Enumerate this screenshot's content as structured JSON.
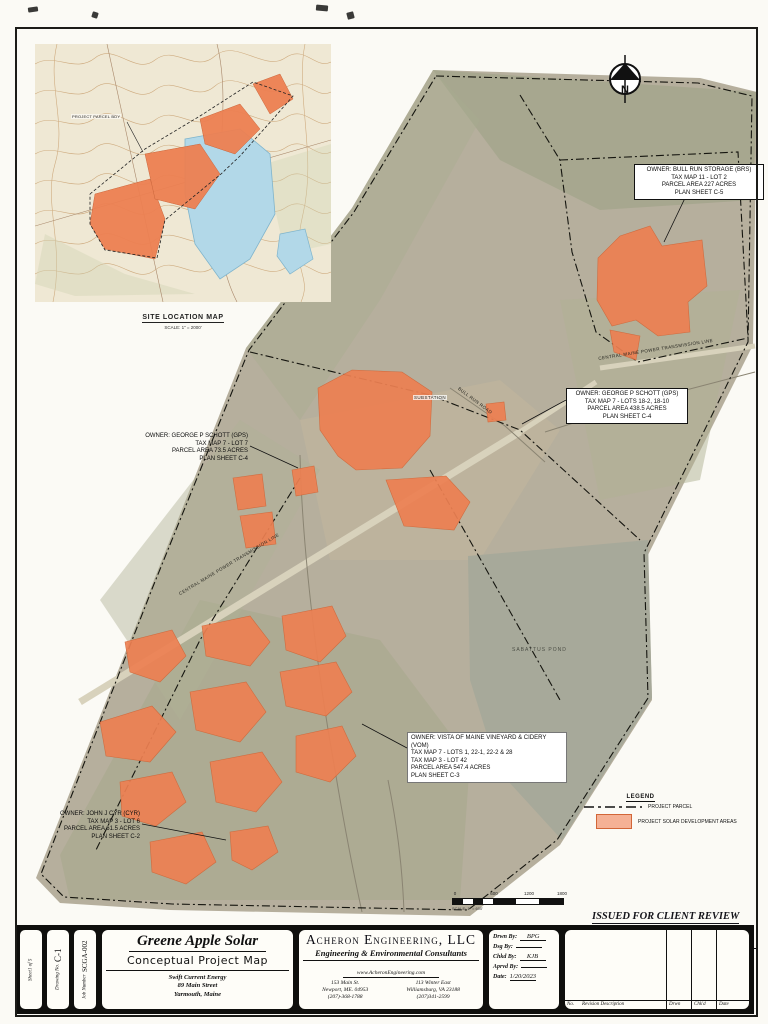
{
  "inset": {
    "title": "SITE LOCATION MAP",
    "scale": "SCALE: 1\" = 2000'",
    "parcel_label": "PROJECT PARCEL BDY"
  },
  "north_label": "N",
  "map_labels": {
    "substation": "SUBSTATION",
    "bull_run_road": "BULL RUN ROAD",
    "cmp_line": "CENTRAL MAINE POWER TRANSMISSION LINE",
    "sabattus_pond": "SABATTUS POND"
  },
  "annotations": {
    "brs": {
      "lines": [
        "OWNER: BULL RUN STORAGE (BRS)",
        "TAX MAP 11 - LOT 2",
        "PARCEL AREA 227 ACRES",
        "PLAN SHEET C-5"
      ]
    },
    "gps_east": {
      "lines": [
        "OWNER: GEORGE P SCHOTT (GPS)",
        "TAX MAP 7 - LOTS 18-2, 18-10",
        "PARCEL AREA 438.5 ACRES",
        "PLAN SHEET C-4"
      ]
    },
    "gps_west": {
      "lines": [
        "OWNER: GEORGE P SCHOTT (GPS)",
        "TAX MAP 7 - LOT 7",
        "PARCEL AREA 73.5 ACRES",
        "PLAN SHEET C-4"
      ]
    },
    "vom": {
      "lines": [
        "OWNER: VISTA OF MAINE VINEYARD & CIDERY (VOM)",
        "TAX MAP 7 - LOTS 1, 22-1, 22-2 & 28",
        "TAX MAP 3 - LOT 42",
        "PARCEL AREA 547.4 ACRES",
        "PLAN SHEET C-3"
      ]
    },
    "cyr": {
      "lines": [
        "OWNER: JOHN J CYR (CYR)",
        "TAX MAP 3 - LOT 6",
        "PARCEL AREA 61.5 ACRES",
        "PLAN SHEET C-2"
      ]
    }
  },
  "legend": {
    "title": "LEGEND",
    "parcel_label": "PROJECT PARCEL",
    "solar_label": "PROJECT SOLAR DEVELOPMENT AREAS"
  },
  "scalebar": {
    "ticks": [
      "0",
      "600",
      "1200",
      "1800"
    ],
    "caption": "SCALE: 1\" = 600'"
  },
  "stamp": {
    "line1": "ISSUED FOR CLIENT REVIEW",
    "line2": "DO NOT USE FOR CONSTRUCTION"
  },
  "titleblock": {
    "project": {
      "title": "Greene Apple Solar",
      "subtitle": "Conceptual Project Map",
      "client": [
        "Swift Current Energy",
        "89 Main Street",
        "Yarmouth, Maine"
      ]
    },
    "firm": {
      "name": "Acheron Engineering, LLC",
      "tagline": "Engineering & Environmental Consultants",
      "website": "www.AcheronEngineering.com",
      "office1": [
        "153 Main St.",
        "Newport, ME. 04953",
        "(207)-368-1788"
      ],
      "office2": [
        "113 Winter East",
        "Williamsburg, VA 23188",
        "(207)341-2599"
      ]
    },
    "fields": [
      {
        "label": "Drwn By:",
        "value": "BPG"
      },
      {
        "label": "Dsg By:",
        "value": ""
      },
      {
        "label": "Chkd By:",
        "value": "KJB"
      },
      {
        "label": "Aprvd By:",
        "value": ""
      },
      {
        "label": "Date:",
        "value": "1/20/2023"
      }
    ],
    "revision": {
      "no": "No.",
      "description": "Revision Description",
      "drwn": "Drwn",
      "chkd": "Chk'd",
      "date": "Date"
    }
  },
  "sheet_meta": {
    "sheet": {
      "label": "Sheet",
      "value": "1 of 5"
    },
    "drawing": {
      "label": "Drawing No.",
      "value": "C-1"
    },
    "job": {
      "label": "Job Number",
      "value": "SCGA-002"
    }
  },
  "colors": {
    "solar_fill": "#ED8052",
    "solar_stroke": "#D26638",
    "photo_base": "#B6AF9D",
    "pond": "#A7A99A",
    "inset_water": "#B2D8E8",
    "paper": "#FBFAF5"
  }
}
